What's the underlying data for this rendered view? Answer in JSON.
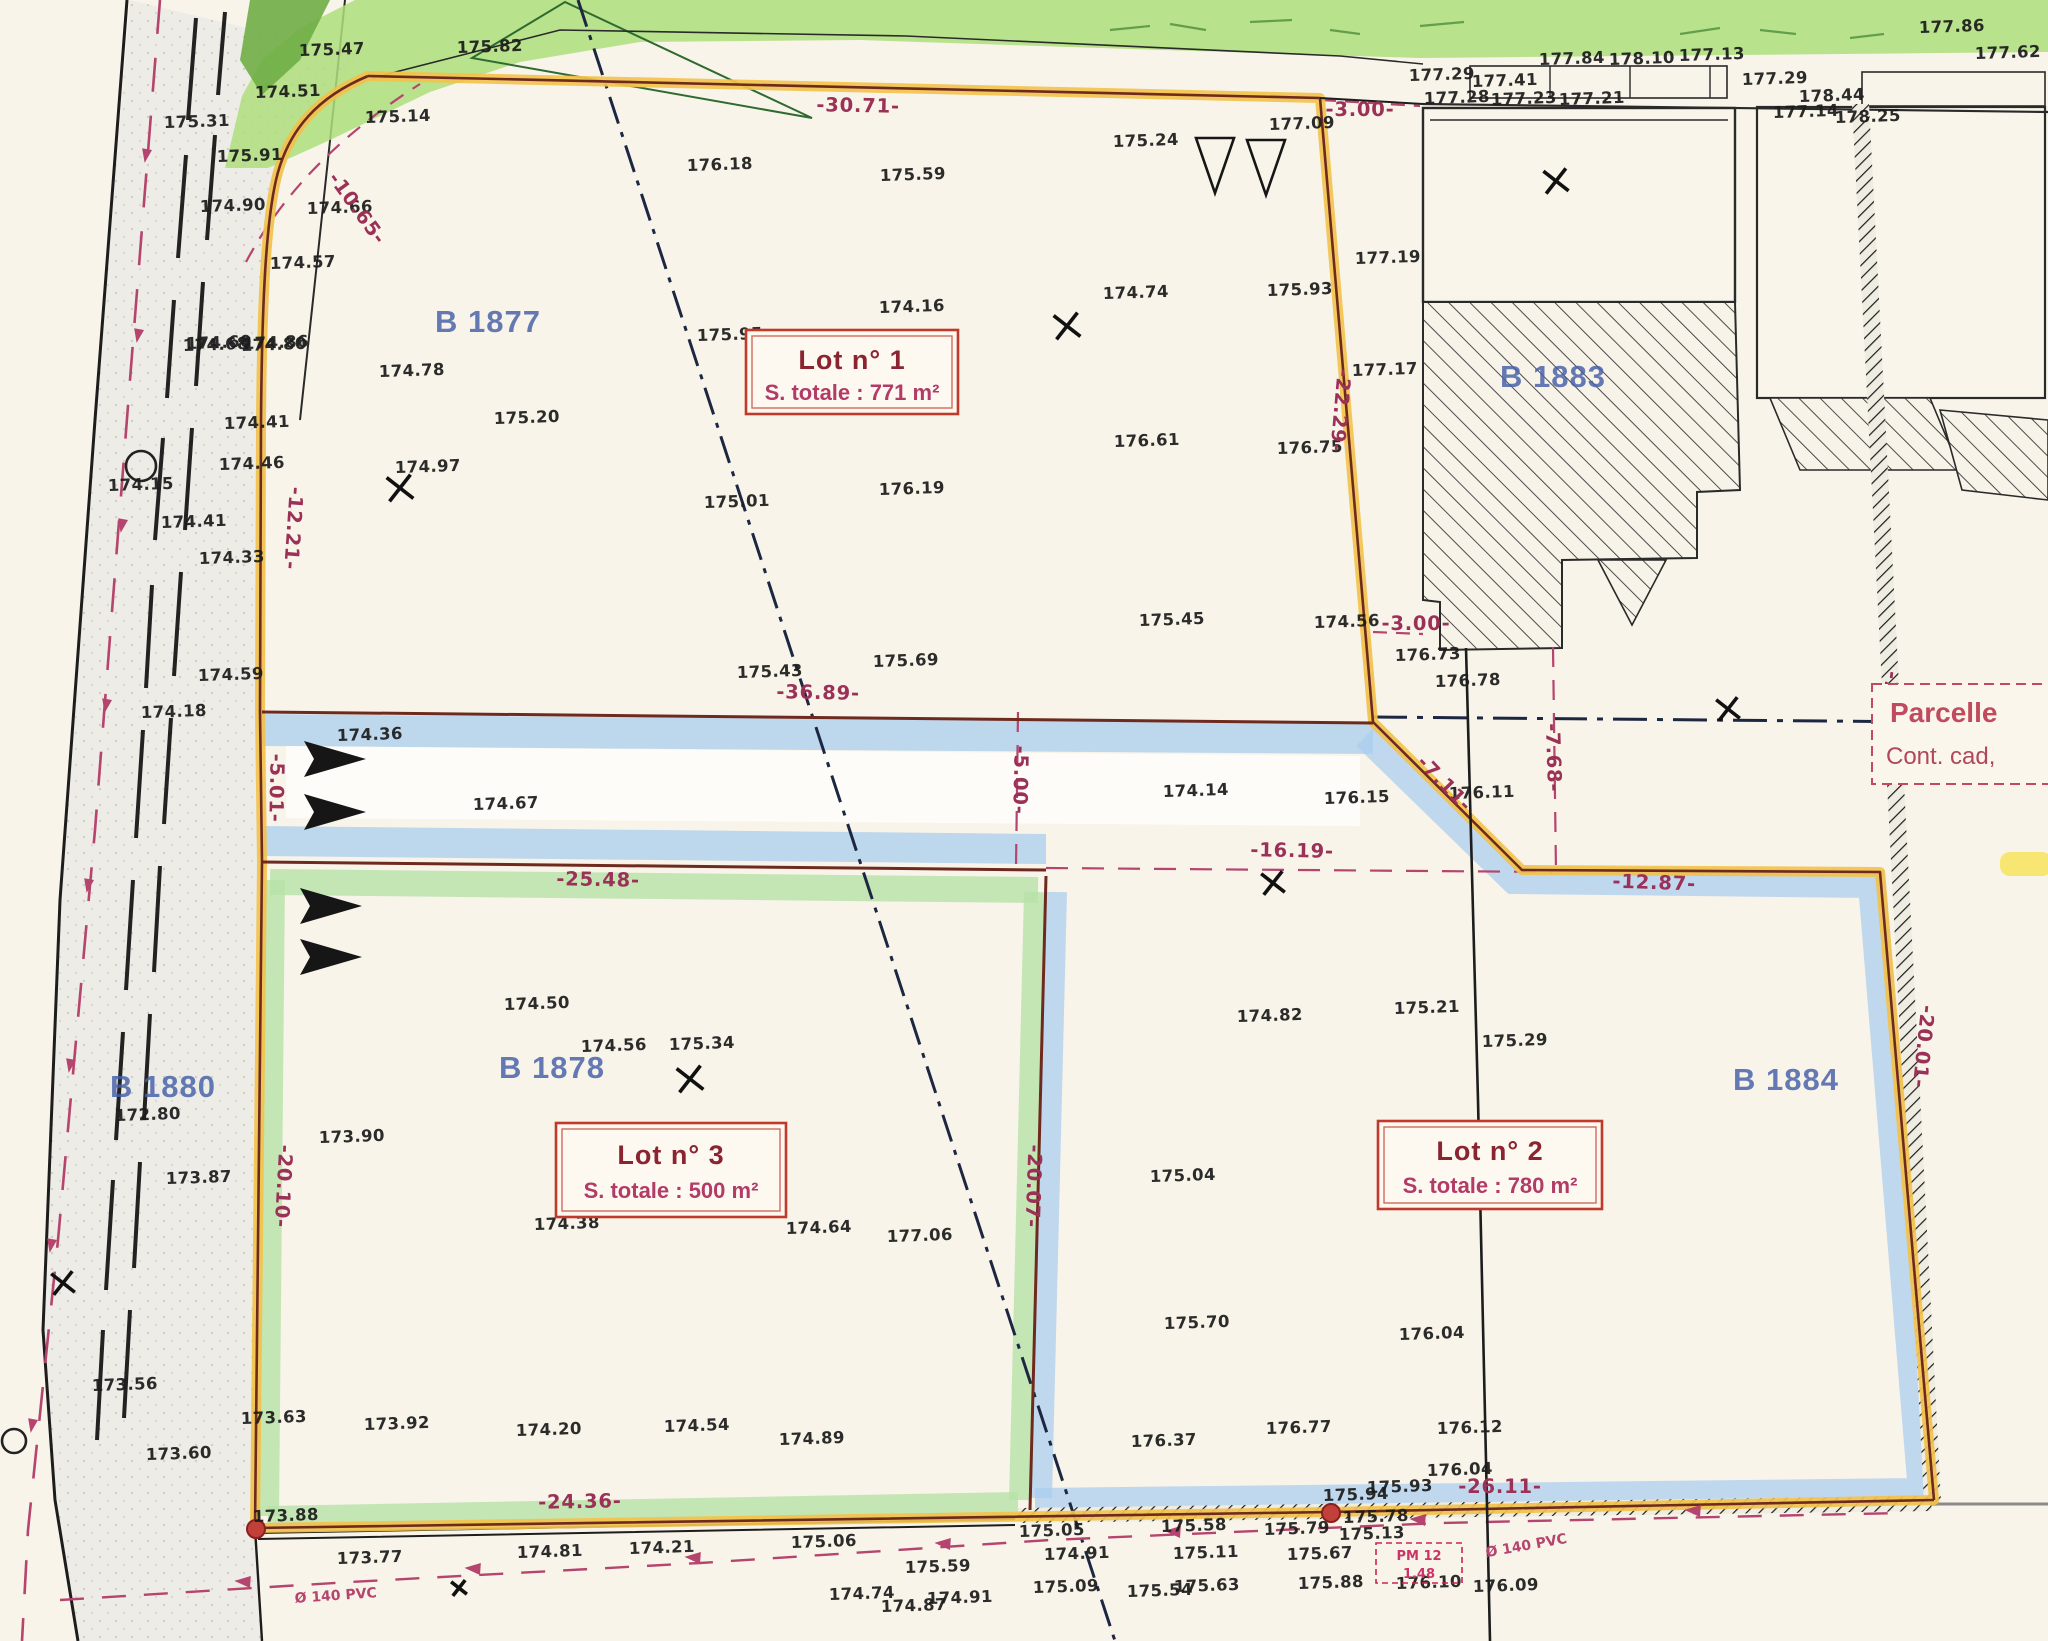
{
  "map": {
    "type": "cadastral-subdivision-plan",
    "colors": {
      "paper": "#f8f4ea",
      "boundary_yellow": "#f2c24c",
      "boundary_core": "#6e2a1e",
      "easement_blue": "#a9cdee",
      "lot_green": "#b6e2a8",
      "vegetation_green": "#aede7d",
      "dimension_magenta": "#9b3157",
      "parcel_blue": "#445fa8",
      "lot_box_red": "#c0392b"
    },
    "lots": [
      {
        "name": "Lot n° 1",
        "area_label": "S. totale : 771 m²"
      },
      {
        "name": "Lot n° 2",
        "area_label": "S. totale : 780 m²"
      },
      {
        "name": "Lot n° 3",
        "area_label": "S. totale : 500 m²"
      }
    ],
    "parcels": [
      {
        "label": "B 1877"
      },
      {
        "label": "B 1878"
      },
      {
        "label": "B 1880"
      },
      {
        "label": "B 1883"
      },
      {
        "label": "B 1884"
      }
    ],
    "parcelle_note": {
      "line1": "Parcelle",
      "line2": "Cont. cad,"
    },
    "pm_note": {
      "line1": "PM 12",
      "line2": "1.48"
    },
    "dimensions": [
      [
        "-30.71-",
        858,
        112,
        1
      ],
      [
        "-3.00-",
        1360,
        116,
        0
      ],
      [
        "-3.00-",
        1416,
        630,
        0
      ],
      [
        "-10.65-",
        352,
        212,
        54
      ],
      [
        "-12.21-",
        287,
        528,
        94
      ],
      [
        "-22.29-",
        1334,
        410,
        95
      ],
      [
        "-36.89-",
        818,
        699,
        1
      ],
      [
        "-25.48-",
        598,
        886,
        1
      ],
      [
        "-5.00-",
        1014,
        780,
        91
      ],
      [
        "-5.01-",
        270,
        788,
        91
      ],
      [
        "-16.19-",
        1292,
        857,
        1
      ],
      [
        "-7.11-",
        1440,
        788,
        46
      ],
      [
        "-7.68-",
        1547,
        758,
        88
      ],
      [
        "-18.50-",
        1882,
        712,
        96
      ],
      [
        "-12.87-",
        1654,
        889,
        2
      ],
      [
        "-20.07-",
        1027,
        1186,
        92
      ],
      [
        "-20.10-",
        277,
        1186,
        93
      ],
      [
        "-20.01-",
        1917,
        1046,
        96
      ],
      [
        "-24.36-",
        580,
        1508,
        -1
      ],
      [
        "-26.11-",
        1500,
        1493,
        0
      ]
    ],
    "utility_labels": [
      [
        "Ø 140 PVC",
        336,
        1600,
        -4
      ],
      [
        "Ø 140 PVC",
        1527,
        1550,
        -10
      ]
    ],
    "spot_heights": [
      [
        "175.47",
        332,
        55
      ],
      [
        "175.82",
        490,
        52
      ],
      [
        "174.51",
        288,
        97
      ],
      [
        "175.14",
        398,
        122
      ],
      [
        "175.91",
        250,
        161
      ],
      [
        "175.31",
        197,
        127
      ],
      [
        "174.90",
        233,
        211
      ],
      [
        "174.66",
        340,
        213
      ],
      [
        "174.57",
        303,
        268
      ],
      [
        "174.68",
        216,
        350
      ],
      [
        "174.80",
        274,
        350
      ],
      [
        "174.78",
        412,
        376
      ],
      [
        "175.20",
        527,
        423
      ],
      [
        "174.97",
        428,
        472
      ],
      [
        "176.18",
        720,
        170
      ],
      [
        "175.59",
        913,
        180
      ],
      [
        "175.24",
        1146,
        146
      ],
      [
        "177.09",
        1302,
        129
      ],
      [
        "174.16",
        912,
        312
      ],
      [
        "174.74",
        1136,
        298
      ],
      [
        "175.93",
        1300,
        295
      ],
      [
        "175.95",
        730,
        340
      ],
      [
        "175.01",
        737,
        507
      ],
      [
        "176.19",
        912,
        494
      ],
      [
        "176.61",
        1147,
        446
      ],
      [
        "176.75",
        1310,
        453
      ],
      [
        "175.45",
        1172,
        625
      ],
      [
        "175.69",
        906,
        666
      ],
      [
        "174.56",
        1347,
        627
      ],
      [
        "175.43",
        770,
        677
      ],
      [
        "177.19",
        1388,
        263
      ],
      [
        "177.17",
        1385,
        375
      ],
      [
        "176.73",
        1428,
        660
      ],
      [
        "176.78",
        1468,
        686
      ],
      [
        "177.29",
        1442,
        80
      ],
      [
        "177.41",
        1505,
        86
      ],
      [
        "177.84",
        1572,
        64
      ],
      [
        "178.10",
        1642,
        64
      ],
      [
        "177.13",
        1712,
        60
      ],
      [
        "177.29",
        1775,
        84
      ],
      [
        "177.28",
        1457,
        103
      ],
      [
        "177.23",
        1524,
        104
      ],
      [
        "177.21",
        1592,
        104
      ],
      [
        "178.44",
        1832,
        101
      ],
      [
        "177.14",
        1806,
        117
      ],
      [
        "178.25",
        1868,
        122
      ],
      [
        "177.86",
        1952,
        32
      ],
      [
        "177.62",
        2008,
        58
      ],
      [
        "174.36",
        370,
        740
      ],
      [
        "174.67",
        506,
        809
      ],
      [
        "174.14",
        1196,
        796
      ],
      [
        "176.15",
        1357,
        803
      ],
      [
        "176.11",
        1482,
        798
      ],
      [
        "173.90",
        352,
        1142
      ],
      [
        "174.50",
        537,
        1009
      ],
      [
        "174.56",
        614,
        1051
      ],
      [
        "175.34",
        702,
        1049
      ],
      [
        "174.38",
        567,
        1229
      ],
      [
        "174.64",
        819,
        1233
      ],
      [
        "173.92",
        397,
        1429
      ],
      [
        "174.20",
        549,
        1435
      ],
      [
        "174.54",
        697,
        1431
      ],
      [
        "174.89",
        812,
        1444
      ],
      [
        "174.82",
        1270,
        1021
      ],
      [
        "175.21",
        1427,
        1013
      ],
      [
        "175.04",
        1183,
        1181
      ],
      [
        "175.29",
        1515,
        1046
      ],
      [
        "175.70",
        1197,
        1328
      ],
      [
        "176.04",
        1432,
        1339
      ],
      [
        "177.06",
        920,
        1241
      ],
      [
        "176.37",
        1164,
        1446
      ],
      [
        "176.77",
        1299,
        1433
      ],
      [
        "176.12",
        1470,
        1433
      ],
      [
        "176.04",
        1460,
        1475
      ],
      [
        "175.94",
        1356,
        1500
      ],
      [
        "175.93",
        1400,
        1492
      ],
      [
        "173.88",
        286,
        1521
      ],
      [
        "173.77",
        370,
        1563
      ],
      [
        "174.81",
        550,
        1557
      ],
      [
        "174.21",
        662,
        1553
      ],
      [
        "175.06",
        824,
        1547
      ],
      [
        "175.59",
        938,
        1572
      ],
      [
        "174.74",
        862,
        1599
      ],
      [
        "174.87",
        914,
        1611
      ],
      [
        "174.91",
        960,
        1603
      ],
      [
        "175.05",
        1052,
        1536
      ],
      [
        "174.91",
        1077,
        1559
      ],
      [
        "175.09",
        1066,
        1592
      ],
      [
        "175.54",
        1160,
        1596
      ],
      [
        "175.63",
        1207,
        1591
      ],
      [
        "175.11",
        1206,
        1558
      ],
      [
        "175.58",
        1194,
        1531
      ],
      [
        "175.79",
        1297,
        1534
      ],
      [
        "175.67",
        1320,
        1559
      ],
      [
        "175.88",
        1331,
        1588
      ],
      [
        "175.13",
        1372,
        1539
      ],
      [
        "175.78",
        1376,
        1522
      ],
      [
        "176.10",
        1429,
        1588
      ],
      [
        "176.09",
        1506,
        1591
      ],
      [
        "174.60",
        219,
        348
      ],
      [
        "174.86",
        276,
        348
      ],
      [
        "174.41",
        257,
        428
      ],
      [
        "174.46",
        252,
        469
      ],
      [
        "174.41",
        194,
        527
      ],
      [
        "174.33",
        232,
        563
      ],
      [
        "174.15",
        141,
        490
      ],
      [
        "174.59",
        231,
        680
      ],
      [
        "174.18",
        174,
        717
      ],
      [
        "172.80",
        148,
        1120
      ],
      [
        "173.87",
        199,
        1183
      ],
      [
        "173.56",
        125,
        1390
      ],
      [
        "173.60",
        179,
        1459
      ],
      [
        "173.63",
        274,
        1423
      ]
    ],
    "symbols": {
      "flow_arrows": [
        [
          304,
          737
        ],
        [
          304,
          790
        ],
        [
          300,
          884
        ],
        [
          300,
          935
        ]
      ],
      "nabla_markers": [
        [
          1196,
          138
        ],
        [
          1247,
          140
        ]
      ],
      "crosses": [
        [
          1067,
          326,
          17
        ],
        [
          400,
          488,
          17
        ],
        [
          690,
          1079,
          17
        ],
        [
          1273,
          883,
          15
        ],
        [
          1556,
          181,
          16
        ],
        [
          63,
          1283,
          15
        ],
        [
          1728,
          709,
          15
        ],
        [
          459,
          1588,
          10
        ]
      ],
      "boundary_points_red": [
        [
          256,
          1529
        ],
        [
          1331,
          1513
        ]
      ],
      "manhole_circles": [
        [
          141,
          466,
          15
        ],
        [
          14,
          1441,
          12
        ]
      ],
      "centerline_arrows": [
        [
          152,
          150
        ],
        [
          144,
          330
        ],
        [
          128,
          520
        ],
        [
          112,
          700
        ],
        [
          94,
          880
        ],
        [
          76,
          1060
        ],
        [
          57,
          1240
        ],
        [
          38,
          1420
        ]
      ],
      "utility_arrows": [
        [
          250,
          1588
        ],
        [
          480,
          1575
        ],
        [
          700,
          1564
        ],
        [
          950,
          1550
        ],
        [
          1180,
          1538
        ],
        [
          1425,
          1526
        ],
        [
          1700,
          1517
        ]
      ]
    }
  }
}
